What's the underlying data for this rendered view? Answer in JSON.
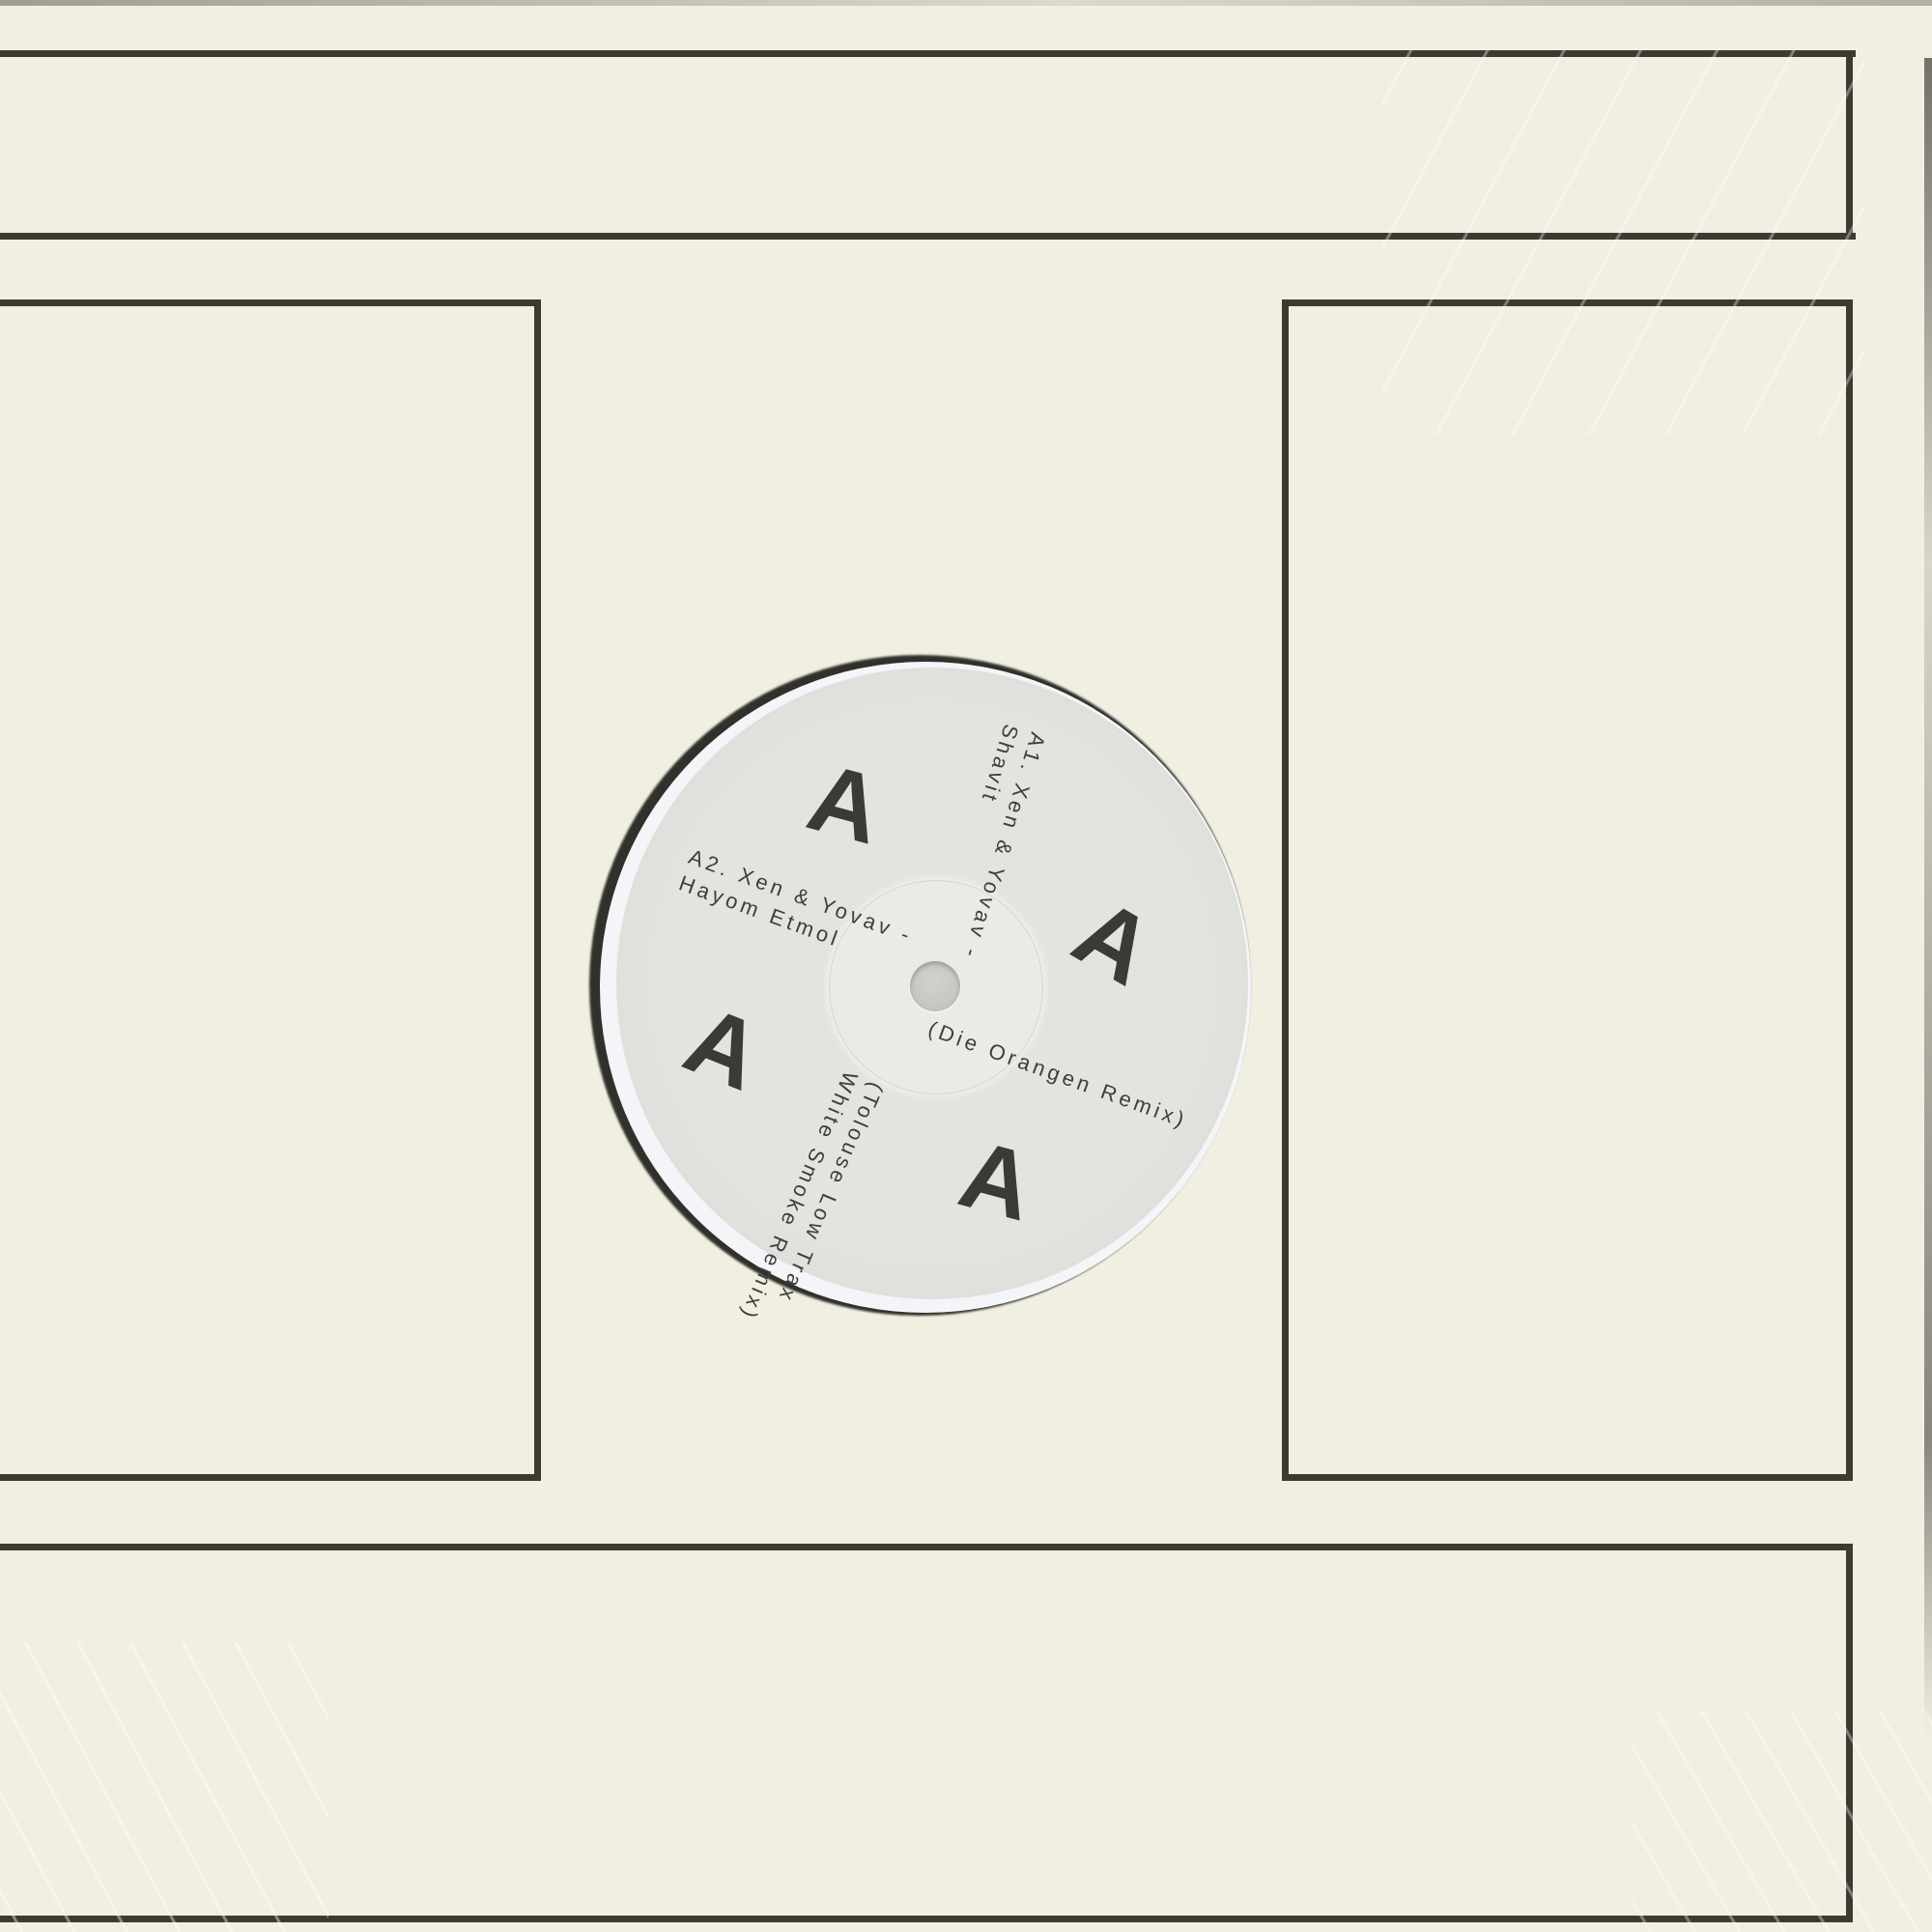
{
  "colors": {
    "cream": "#f1efe1",
    "rule": "#3b3b31",
    "label": "#e1e4df",
    "vinyl": "#f3f5f8",
    "cutout": "#31312b",
    "ring": "#e8ebe6",
    "hole": "#c9c8c3",
    "ink": "#3e3e3a"
  },
  "label": {
    "side_letter": "A",
    "a1_line1": "A1. Xen & Yovav -",
    "a1_line2": "Shavit",
    "remix1": "(Die Orangen Remix)",
    "a2_line1": "A2. Xen & Yovav -",
    "a2_line2": "Hayom Etmol",
    "remix2_line1": "(Tolouse Low Trax",
    "remix2_line2": "White Smoke Remix)"
  }
}
